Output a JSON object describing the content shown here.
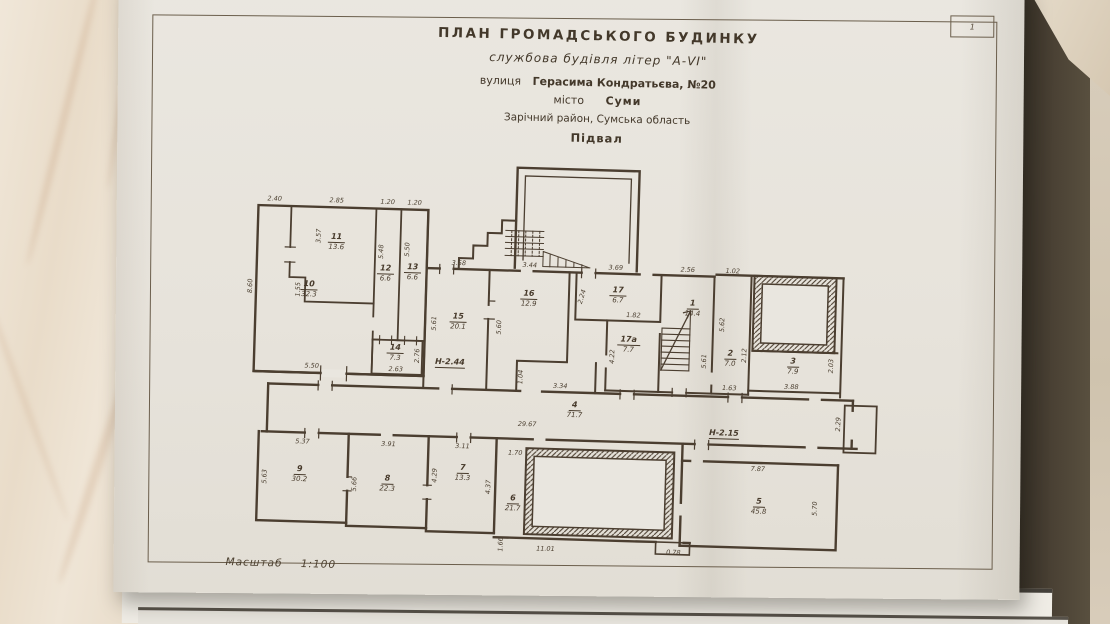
{
  "page": {
    "number": "1"
  },
  "title": {
    "line1": "ПЛАН  ГРОМАДСЬКОГО  БУДИНКУ",
    "line2": "службова будівля літер \"А-VI\"",
    "street_label": "вулиця",
    "street_value": "Герасима Кондратьєва, №20",
    "city_label": "місто",
    "city_value": "Суми",
    "district": "Зарічний район, Сумська область",
    "floor": "Підвал"
  },
  "scale": {
    "label": "Масштаб",
    "value": "1:100"
  },
  "colors": {
    "ink": "#4b3e30",
    "paper": "#e9e6df",
    "marble": "#ece1d1",
    "table_edge": "#453c2f"
  },
  "plan": {
    "rooms": [
      {
        "num": "10",
        "area": "32.3",
        "x": 138,
        "y": 140
      },
      {
        "num": "11",
        "area": "13.6",
        "x": 164,
        "y": 92
      },
      {
        "num": "12",
        "area": "6.6",
        "x": 214,
        "y": 122
      },
      {
        "num": "13",
        "area": "6.6",
        "x": 241,
        "y": 120
      },
      {
        "num": "14",
        "area": "7.3",
        "x": 226,
        "y": 201
      },
      {
        "num": "15",
        "area": "20.1",
        "x": 288,
        "y": 168
      },
      {
        "num": "16",
        "area": "12.9",
        "x": 358,
        "y": 143
      },
      {
        "num": "17",
        "area": "6.7",
        "x": 447,
        "y": 137
      },
      {
        "num": "17а",
        "area": "7.7",
        "x": 459,
        "y": 186
      },
      {
        "num": "1",
        "area": "14.4",
        "x": 522,
        "y": 148
      },
      {
        "num": "2",
        "area": "7.0",
        "x": 561,
        "y": 197
      },
      {
        "num": "3",
        "area": "7.9",
        "x": 624,
        "y": 203
      },
      {
        "num": "4",
        "area": "71.7",
        "x": 407,
        "y": 253
      },
      {
        "num": "9",
        "area": "30.2",
        "x": 134,
        "y": 325
      },
      {
        "num": "8",
        "area": "22.3",
        "x": 222,
        "y": 332
      },
      {
        "num": "7",
        "area": "13.3",
        "x": 297,
        "y": 319
      },
      {
        "num": "6",
        "area": "21.7",
        "x": 348,
        "y": 348
      },
      {
        "num": "5",
        "area": "45.8",
        "x": 594,
        "y": 344
      }
    ],
    "dims": [
      {
        "t": "2.40",
        "x": 101,
        "y": 50
      },
      {
        "t": "2.85",
        "x": 163,
        "y": 50
      },
      {
        "t": "1.20",
        "x": 214,
        "y": 50
      },
      {
        "t": "1.20",
        "x": 241,
        "y": 50
      },
      {
        "t": "3.57",
        "x": 146,
        "y": 86,
        "r": -90
      },
      {
        "t": "8.60",
        "x": 79,
        "y": 138,
        "r": -90
      },
      {
        "t": "1.55",
        "x": 127,
        "y": 140,
        "r": -90
      },
      {
        "t": "5.50",
        "x": 143,
        "y": 216
      },
      {
        "t": "5.48",
        "x": 209,
        "y": 100,
        "r": -90
      },
      {
        "t": "5.50",
        "x": 235,
        "y": 97,
        "r": -90
      },
      {
        "t": "2.63",
        "x": 227,
        "y": 217
      },
      {
        "t": "2.76",
        "x": 248,
        "y": 203,
        "r": -90
      },
      {
        "t": "3.58",
        "x": 287,
        "y": 109
      },
      {
        "t": "5.61",
        "x": 264,
        "y": 170,
        "r": -90
      },
      {
        "t": "3.44",
        "x": 358,
        "y": 109
      },
      {
        "t": "5.60",
        "x": 329,
        "y": 172,
        "r": -90
      },
      {
        "t": "1.04",
        "x": 352,
        "y": 221,
        "r": -90
      },
      {
        "t": "3.34",
        "x": 392,
        "y": 229
      },
      {
        "t": "3.69",
        "x": 444,
        "y": 109
      },
      {
        "t": "2.24",
        "x": 411,
        "y": 139,
        "r": -75
      },
      {
        "t": "1.82",
        "x": 463,
        "y": 156
      },
      {
        "t": "4.22",
        "x": 443,
        "y": 198,
        "r": -90
      },
      {
        "t": "2.56",
        "x": 516,
        "y": 109
      },
      {
        "t": "5.61",
        "x": 535,
        "y": 200,
        "r": -90
      },
      {
        "t": "1.02",
        "x": 561,
        "y": 109
      },
      {
        "t": "5.62",
        "x": 552,
        "y": 163,
        "r": -90
      },
      {
        "t": "2.12",
        "x": 575,
        "y": 193,
        "r": -90
      },
      {
        "t": "1.63",
        "x": 561,
        "y": 226
      },
      {
        "t": "3.88",
        "x": 623,
        "y": 223
      },
      {
        "t": "2.03",
        "x": 662,
        "y": 201,
        "r": -90
      },
      {
        "t": "29.67",
        "x": 360,
        "y": 268
      },
      {
        "t": "2.29",
        "x": 671,
        "y": 259,
        "r": -90
      },
      {
        "t": "5.37",
        "x": 136,
        "y": 292
      },
      {
        "t": "5.63",
        "x": 99,
        "y": 328,
        "r": -90
      },
      {
        "t": "3.91",
        "x": 222,
        "y": 292
      },
      {
        "t": "5.66",
        "x": 189,
        "y": 333,
        "r": -90
      },
      {
        "t": "3.11",
        "x": 296,
        "y": 292
      },
      {
        "t": "4.29",
        "x": 269,
        "y": 322,
        "r": -90
      },
      {
        "t": "4.37",
        "x": 323,
        "y": 332,
        "r": -90
      },
      {
        "t": "1.70",
        "x": 349,
        "y": 297
      },
      {
        "t": "1.66",
        "x": 337,
        "y": 389,
        "r": -90
      },
      {
        "t": "11.01",
        "x": 382,
        "y": 392
      },
      {
        "t": "0.78",
        "x": 510,
        "y": 392
      },
      {
        "t": "7.87",
        "x": 592,
        "y": 306
      },
      {
        "t": "5.70",
        "x": 650,
        "y": 344,
        "r": -90
      }
    ],
    "height_marks": [
      {
        "t": "Н-2.44",
        "x": 281,
        "y": 209
      },
      {
        "t": "Н-2.15",
        "x": 557,
        "y": 272
      }
    ]
  }
}
